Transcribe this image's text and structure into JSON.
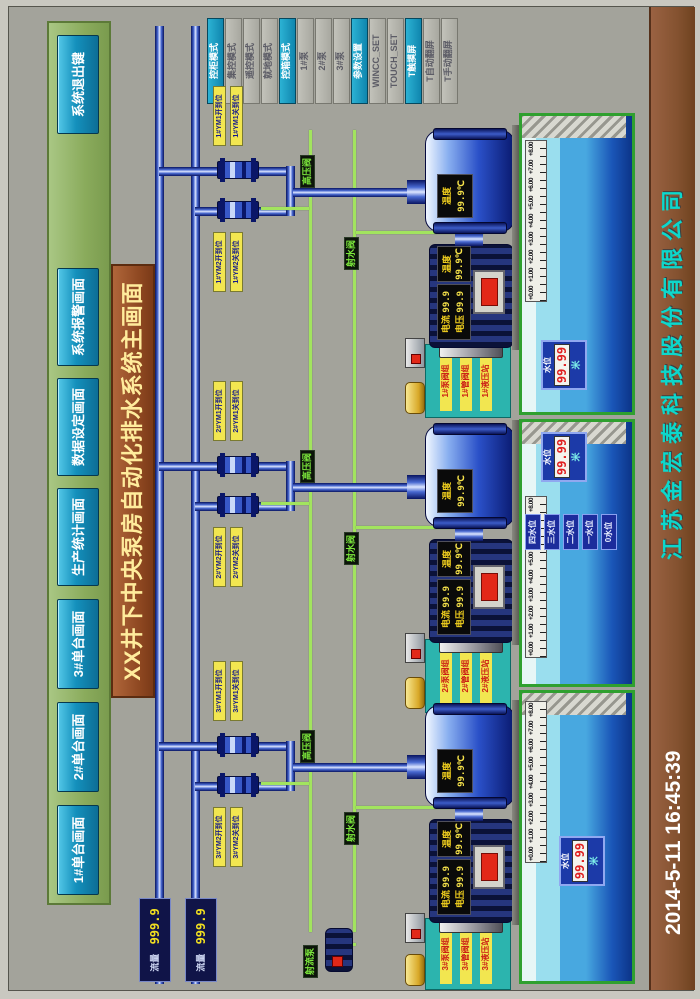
{
  "title": "XX井下中央泵房自动化排水系统主画面",
  "nav": {
    "buttons": [
      "1#单台画面",
      "2#单台画面",
      "3#单台画面",
      "生产统计画面",
      "数据设定画面",
      "系统报警画面"
    ],
    "exit": "系统退出键"
  },
  "side_panel": {
    "buttons": [
      {
        "label": "控柜模式",
        "active": true
      },
      {
        "label": "集控模式",
        "active": false
      },
      {
        "label": "遥控模式",
        "active": false
      },
      {
        "label": "就地模式",
        "active": false
      },
      {
        "label": "控箱模式",
        "active": true
      },
      {
        "label": "1#泵",
        "active": false
      },
      {
        "label": "2#泵",
        "active": false
      },
      {
        "label": "3#泵",
        "active": false
      },
      {
        "label": "参数设置",
        "active": true
      },
      {
        "label": "WINCC_SET",
        "active": false
      },
      {
        "label": "TOUCH_SET",
        "active": false
      },
      {
        "label": "T触摸屏",
        "active": true
      },
      {
        "label": "T自动翻屏",
        "active": false
      },
      {
        "label": "T手动翻屏",
        "active": false
      }
    ]
  },
  "mains": {
    "flow1": {
      "label": "流量",
      "value": "999.9"
    },
    "flow2": {
      "label": "流量",
      "value": "999.9"
    }
  },
  "scale": [
    "+0.00",
    "+1.00",
    "+2.00",
    "+3.00",
    "+4.00",
    "+5.00",
    "+6.00",
    "+7.00",
    "+8.00"
  ],
  "level_tags": [
    "四水位",
    "三水位",
    "二水位",
    "一水位",
    "0水位"
  ],
  "jet_pump": {
    "label": "射流泵"
  },
  "units": [
    {
      "name": "1#泵",
      "valve_labels": [
        "1#YM1开到位",
        "1#YM1关到位",
        "1#YM2开到位",
        "1#YM2关到位"
      ],
      "hydraulic": [
        "1#泵阀组",
        "1#管阀组",
        "1#液压站"
      ],
      "pump_display": {
        "label": "温度",
        "value": "99.9℃"
      },
      "motor_display": {
        "rows": [
          {
            "label": "电流",
            "value": "99.9"
          },
          {
            "label": "电压",
            "value": "99.9"
          }
        ]
      },
      "motor_temp": {
        "label": "温度",
        "value": "99.9℃"
      },
      "green_valves": [
        "高压阀",
        "射水阀"
      ],
      "level": {
        "label": "水位",
        "value": "99.99",
        "unit": "米"
      }
    },
    {
      "name": "2#泵",
      "valve_labels": [
        "2#YM1开到位",
        "2#YM1关到位",
        "2#YM2开到位",
        "2#YM2关到位"
      ],
      "hydraulic": [
        "2#泵阀组",
        "2#管阀组",
        "2#液压站"
      ],
      "pump_display": {
        "label": "温度",
        "value": "99.9℃"
      },
      "motor_display": {
        "rows": [
          {
            "label": "电流",
            "value": "99.9"
          },
          {
            "label": "电压",
            "value": "99.9"
          }
        ]
      },
      "motor_temp": {
        "label": "温度",
        "value": "99.9℃"
      },
      "green_valves": [
        "高压阀",
        "射水阀"
      ],
      "level": {
        "label": "水位",
        "value": "99.99",
        "unit": "米"
      }
    },
    {
      "name": "3#泵",
      "valve_labels": [
        "3#YM1开到位",
        "3#YM1关到位",
        "3#YM2开到位",
        "3#YM2关到位"
      ],
      "hydraulic": [
        "3#泵阀组",
        "3#管阀组",
        "3#液压站"
      ],
      "pump_display": {
        "label": "温度",
        "value": "99.9℃"
      },
      "motor_display": {
        "rows": [
          {
            "label": "电流",
            "value": "99.9"
          },
          {
            "label": "电压",
            "value": "99.9"
          }
        ]
      },
      "motor_temp": {
        "label": "温度",
        "value": "99.9℃"
      },
      "green_valves": [
        "高压阀",
        "射水阀"
      ],
      "level": {
        "label": "水位",
        "value": "99.99",
        "unit": "米"
      }
    }
  ],
  "footer": {
    "date": "2014-5-11  16:45:39",
    "company": "江苏金宏泰科技股份有限公司"
  },
  "colors": {
    "accent_teal": "#1490bc",
    "alarm_red": "#e22818",
    "pipe_blue": "#1a2a9a",
    "line_green": "#a2e45e",
    "banner_brown": "#8c4620"
  }
}
